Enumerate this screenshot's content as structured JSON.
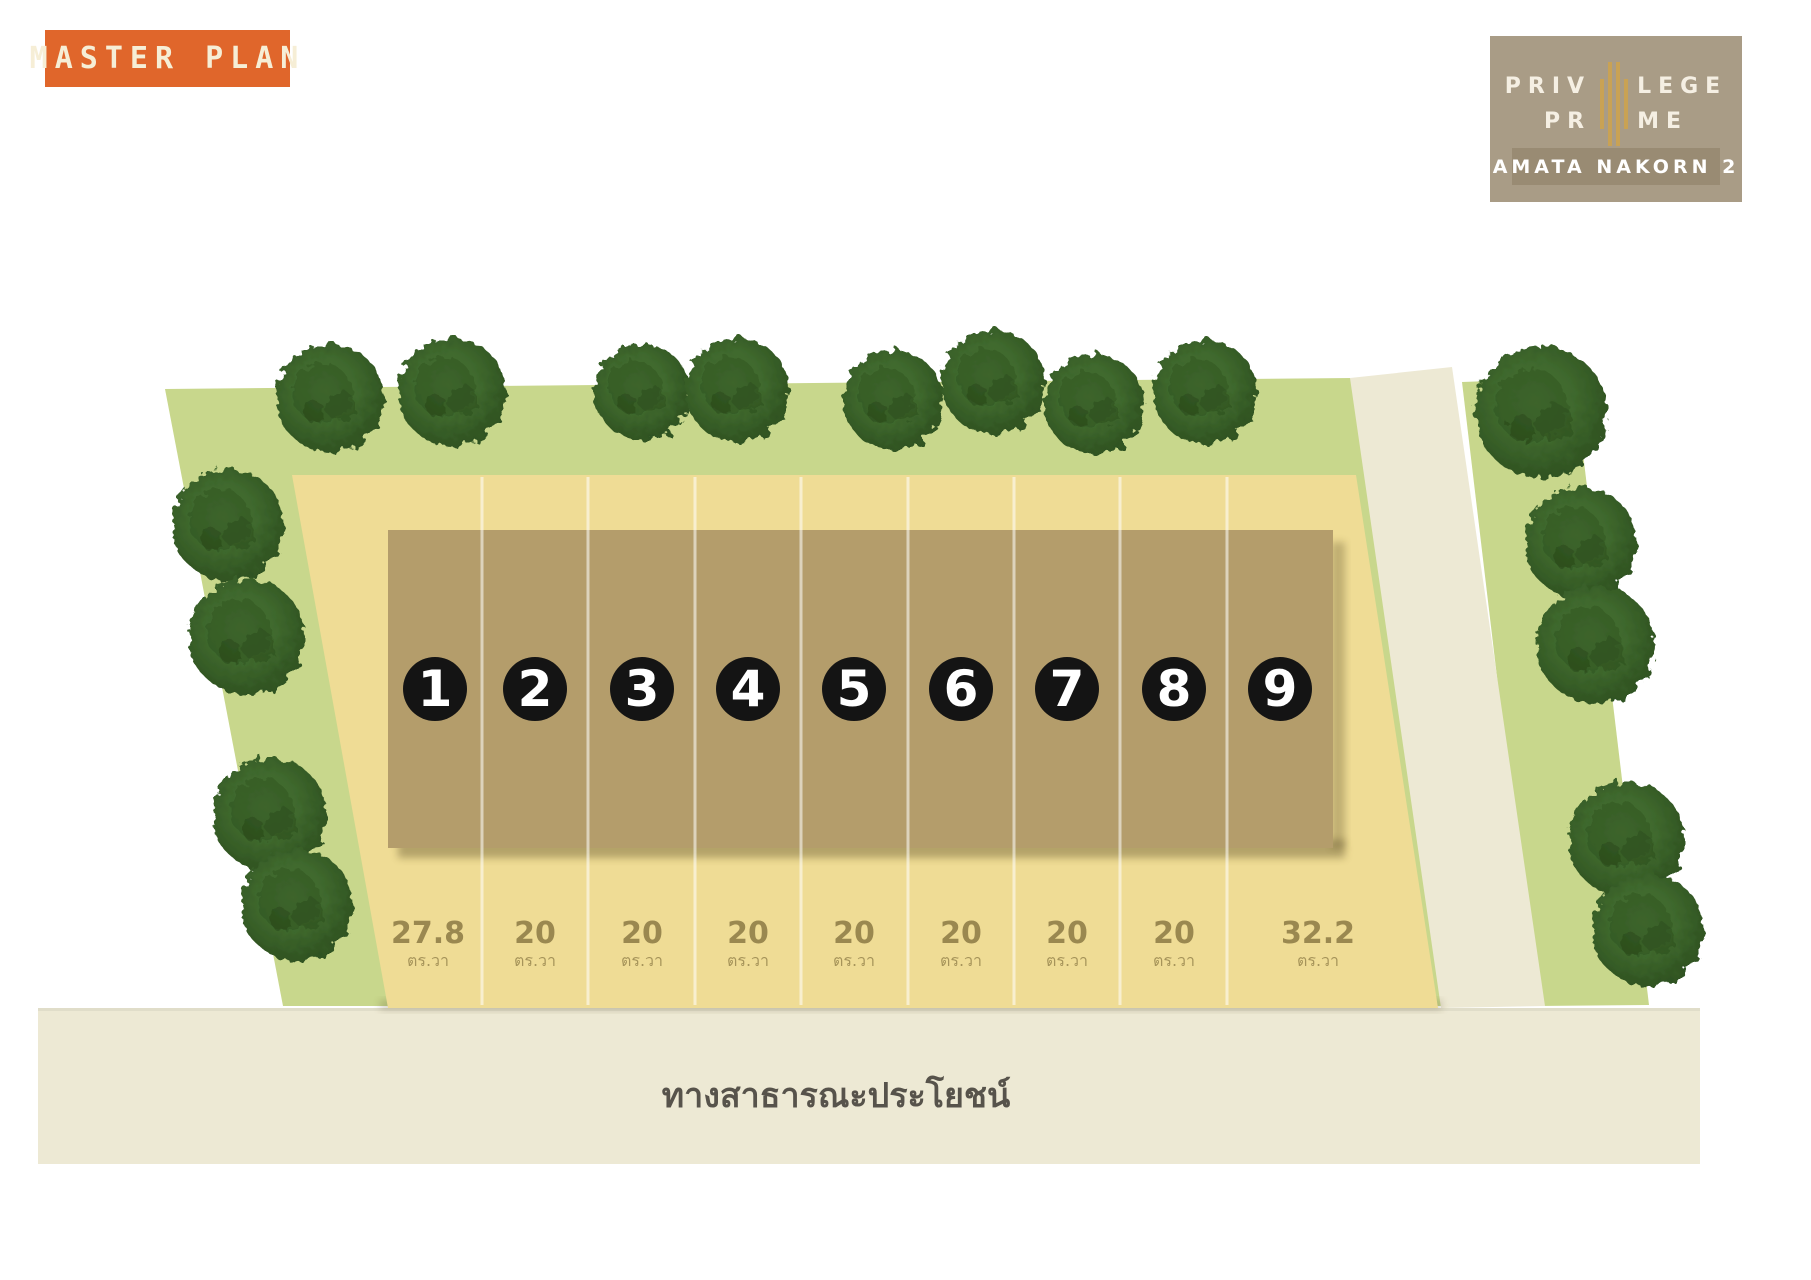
{
  "badge": {
    "label": "MASTER PLAN"
  },
  "logo": {
    "name_line1_left": "PRIV",
    "name_line1_right": "LEGE",
    "name_line2_left": "PR",
    "name_line2_right": "ME",
    "subtitle": "AMATA NAKORN 2"
  },
  "plan": {
    "road_label": "ทางสาธารณะประโยชน์",
    "area_unit": "ตร.วา",
    "plots": [
      {
        "number": "1",
        "area": "27.8"
      },
      {
        "number": "2",
        "area": "20"
      },
      {
        "number": "3",
        "area": "20"
      },
      {
        "number": "4",
        "area": "20"
      },
      {
        "number": "5",
        "area": "20"
      },
      {
        "number": "6",
        "area": "20"
      },
      {
        "number": "7",
        "area": "20"
      },
      {
        "number": "8",
        "area": "20"
      },
      {
        "number": "9",
        "area": "32.2"
      }
    ]
  },
  "colors": {
    "badge_bg": "#E0662B",
    "badge_fg": "#F6EED6",
    "logo_bg": "#A99C86",
    "logo_band_bg": "#998B73",
    "logo_fg": "#F5EFE3",
    "logo_gold": "#C9A254",
    "grass": "#C8D78C",
    "land": "#EFDC95",
    "building": "#B49D6B",
    "road": "#EDE9D4",
    "marker_bg": "#141414",
    "marker_fg": "#FFFFFF",
    "area_text": "#9A8850",
    "road_text": "#57534B"
  }
}
